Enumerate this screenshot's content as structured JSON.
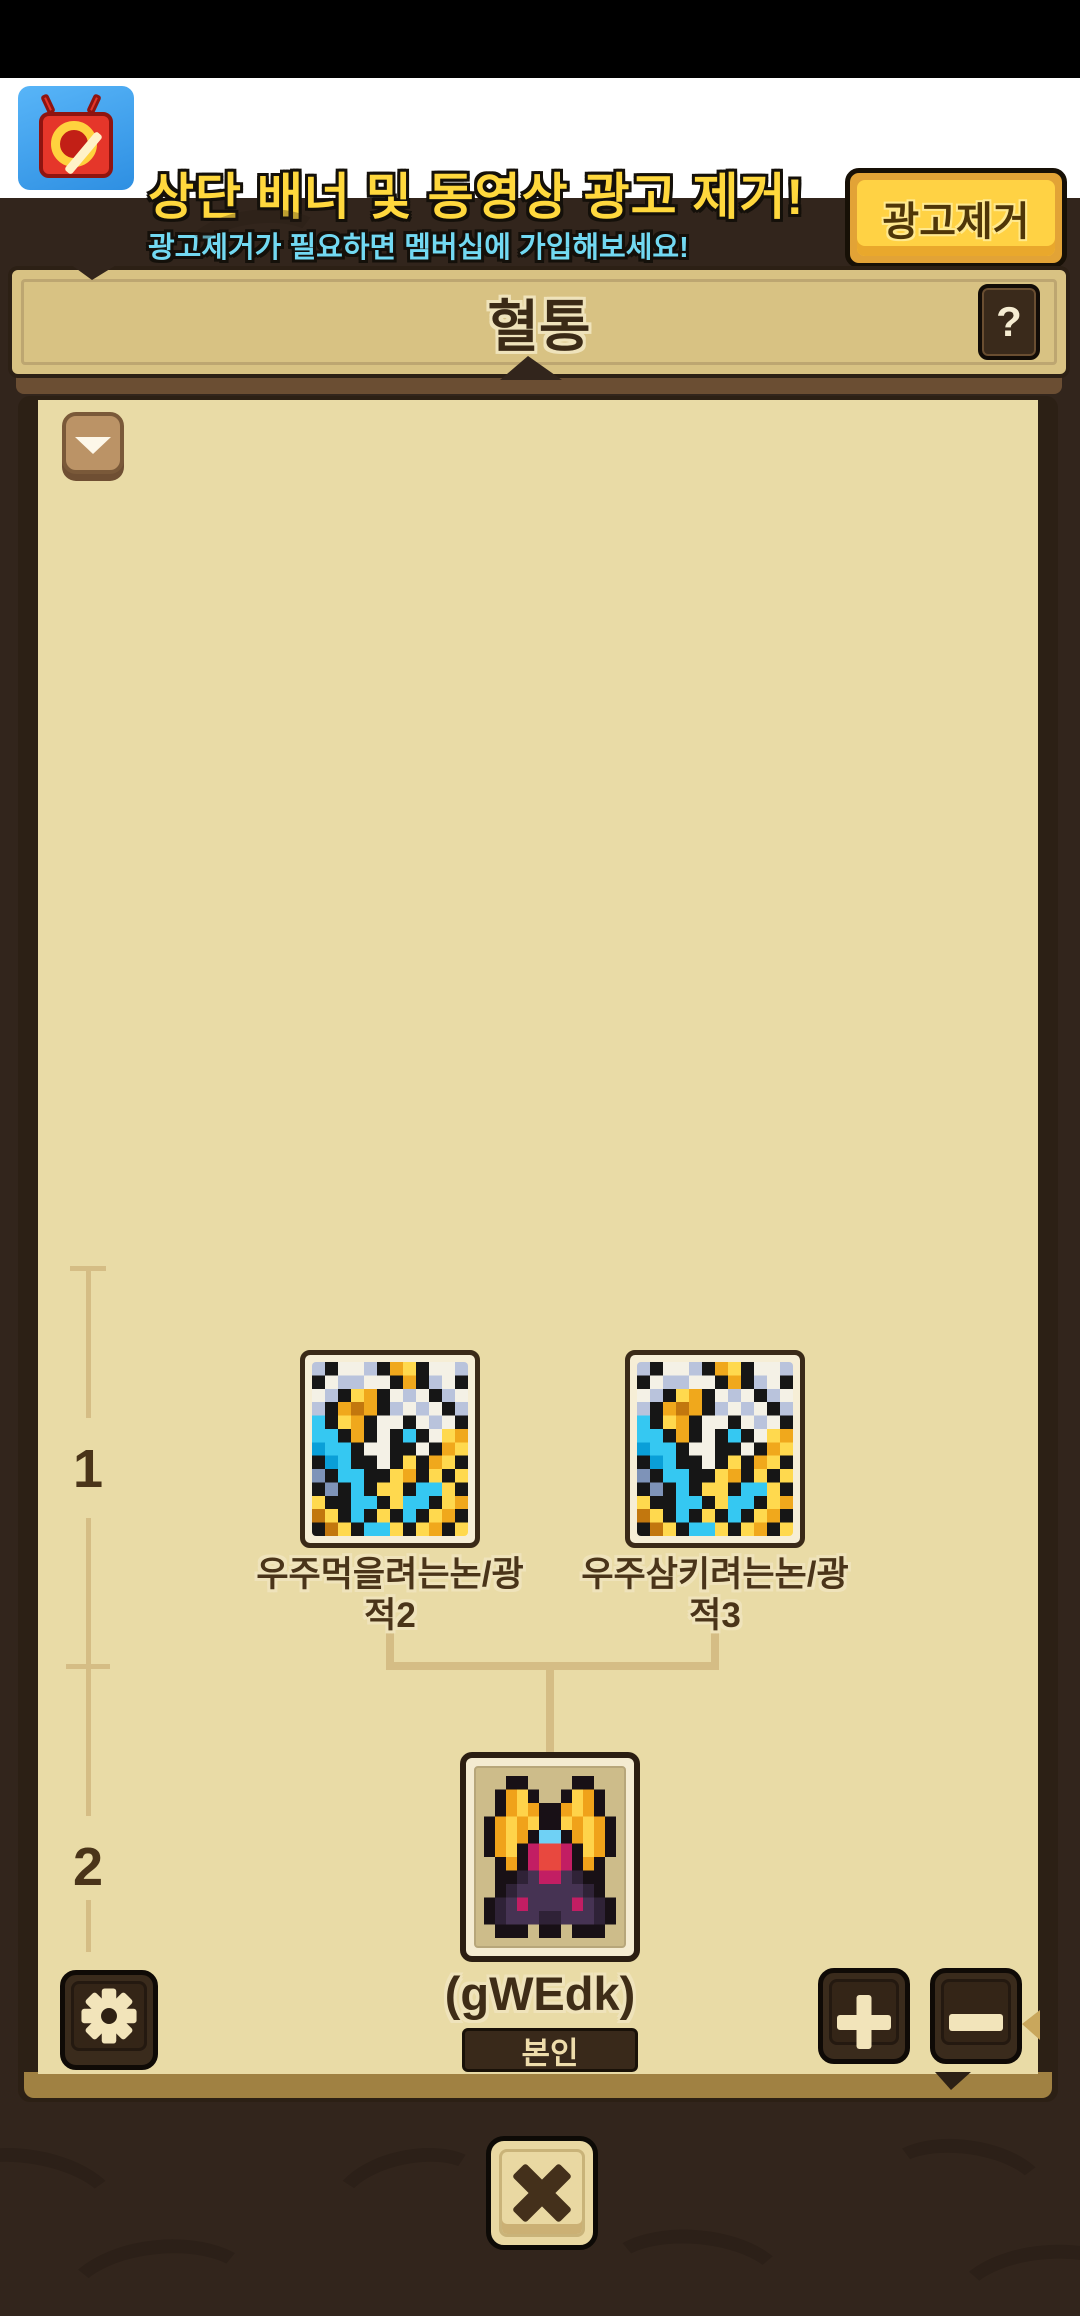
{
  "ad_banner": {
    "line1": "상단 배너 및 동영상 광고 제거!",
    "line2": "광고제거가 필요하면 멤버십에 가입해보세요!",
    "button_label": "광고제거",
    "icon": "no-ads-tv-icon"
  },
  "dialog": {
    "title": "혈통",
    "help_label": "?"
  },
  "tree": {
    "gen1_label": "1",
    "gen2_label": "2",
    "parents": [
      {
        "line1": "우주먹을려는논/광",
        "line2": "적2"
      },
      {
        "line1": "우주삼키려는논/광",
        "line2": "적3"
      }
    ],
    "self": {
      "name": "(gWEdk)",
      "badge": "본인"
    }
  },
  "colors": {
    "background": "#32251c",
    "panel": "#e9dba6",
    "titlebar": "#d8c283",
    "banner_text_yellow": "#ffd83d",
    "banner_text_cyan": "#72d9f2",
    "banner_button_yellow": "#ffd244",
    "connector": "#d5bd85",
    "dark_button": "#3a2b1c",
    "text_brown": "#4a3419",
    "badge_bg": "#39291a",
    "badge_text": "#eedcab"
  },
  "pixel_art": {
    "parent_creature": {
      "palette": {
        "K": "#161616",
        "W": "#f4f1e6",
        "S": "#b9c3dc",
        "C": "#35c8f2",
        "B": "#0a9fd8",
        "G": "#f0a81c",
        "Y": "#ffd94e",
        "O": "#c2770e",
        "D": "#7e93b8"
      },
      "grid": [
        "SKWWSKGYKWWS",
        "KWSSWWKGKSWK",
        "WSKYGKWSWKSW",
        "SKGOGKSWSWKS",
        "CKYGKWWKWSWK",
        "CCKGKWKCKWYG",
        "BCCKWWKKWKGY",
        "KBCKKWKYKGYK",
        "DKCCKKYGKYKY",
        "KDKCKYYKCCYK",
        "YKKCCKYCCKYG",
        "OYKCKYKCKYGK",
        "KOYKCCYKYGKY"
      ]
    },
    "self_creature": {
      "palette": {
        "K": "#181016",
        "G": "#f0a21a",
        "Y": "#ffd34a",
        "P": "#463353",
        "Q": "#2f2237",
        "M": "#c21e63",
        "R": "#e8483f",
        "B": "#6fd1f5"
      },
      "grid": [
        "..KK....KK..",
        ".KGYK..KYGK.",
        ".KGYGKKGYGK.",
        "KGYGYKKYGYGK",
        "KGYGKBBKGYGK",
        "KGYKMRRMKYGK",
        ".KGKMRRMKGK.",
        ".KKQPMMPQKK.",
        ".KQPPPPPPQK.",
        "KQPMPPPPMPQK",
        "KQPPPQQPPPQK",
        ".KKK.KK.KKK."
      ]
    }
  }
}
